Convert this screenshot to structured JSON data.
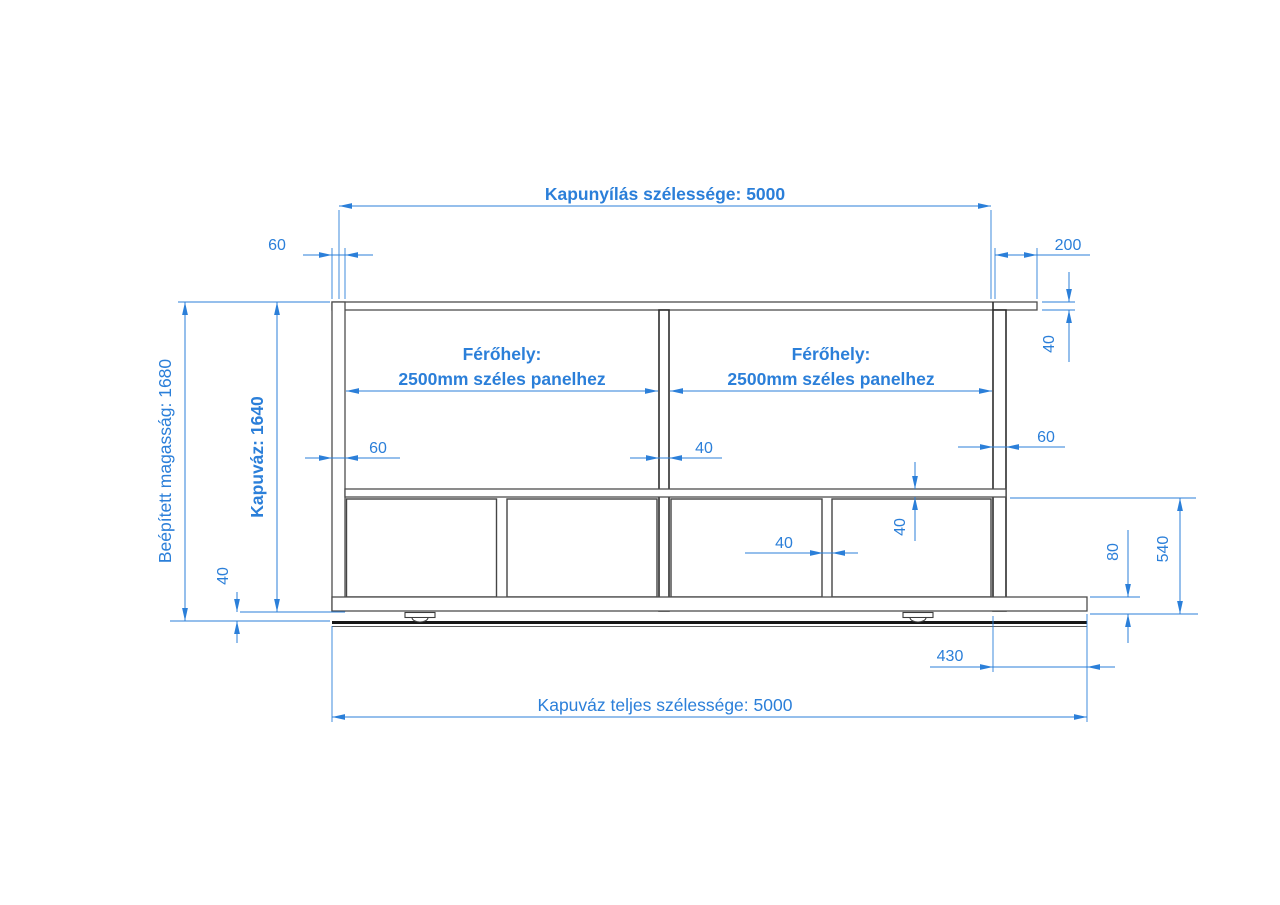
{
  "meta": {
    "background": "#ffffff",
    "dimension_color": "#2b7fd9",
    "structure_color": "#4d4d4d",
    "drawing_subject": "sliding-gate-frame-elevation"
  },
  "labels": {
    "opening_width": "Kapunyílás szélessége: 5000",
    "total_width": "Kapuváz teljes szélessége: 5000",
    "installed_height": "Beépített magasság: 1680",
    "frame_height": "Kapuváz: 1640",
    "bay_left": {
      "line1": "Férőhely:",
      "line2": "2500mm széles panelhez"
    },
    "bay_right": {
      "line1": "Férőhely:",
      "line2": "2500mm széles panelhez"
    }
  },
  "dims": {
    "left_post_width_top": "60",
    "top_right_offset": "200",
    "flange_thickness": "40",
    "left_post_width": "60",
    "center_post_width": "40",
    "right_post_width": "60",
    "mid_rail_thickness": "40",
    "sub_divider_gap": "40",
    "bottom_clearance": "40",
    "bottom_rail_height": "80",
    "lower_section_height": "540",
    "right_overhang": "430"
  }
}
